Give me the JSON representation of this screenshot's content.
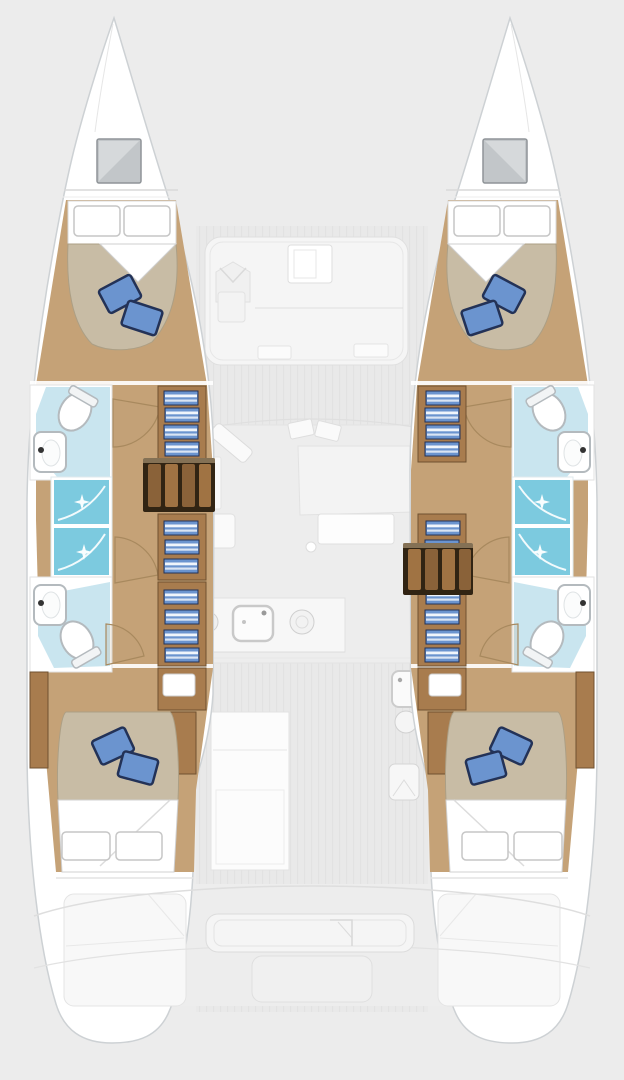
{
  "diagram": {
    "type": "yacht-floor-plan",
    "vessel": "catamaran",
    "view": "top-down interior layout, bows at top",
    "hull_count": 2,
    "counts": {
      "cabins": 4,
      "double_berths": 4,
      "bathrooms": 4,
      "shower_cubicles": 4,
      "bow_hatches": 2,
      "companionway_steps": 2
    },
    "port_hull_features": [
      "bow hatch",
      "forward double cabin with two blue throw pillows",
      "forward bathroom with toilet and washbasin",
      "two shower cubicles",
      "aft bathroom with washbasin and toilet",
      "inboard wardrobe shelving with folded blue linens",
      "companionway steps",
      "aft double cabin with two blue throw pillows",
      "stern platform"
    ],
    "starboard_hull_features": [
      "mirror image of port hull",
      "companionway steps positioned further aft"
    ],
    "center_features": [
      "forward cockpit lounge with table and V-backrest seat",
      "salon sofa",
      "salon table",
      "chaise seat",
      "galley counter with sink and burner",
      "galley island",
      "inboard service units with basin",
      "aft cockpit bench",
      "swim platform"
    ]
  },
  "colors": {
    "bg": "#ececec",
    "deck": "#e9e9e9",
    "deck_stripe": "#e2e2e2",
    "hull_fill": "#ffffff",
    "hull_stroke": "#cdd1d4",
    "faint_line": "#dfdfdf",
    "faint_fill": "#f5f5f5",
    "wood_floor": "#c5a277",
    "cabinet": "#a87c4e",
    "cabinet_edge": "#6f5130",
    "step_dark": "#312413",
    "step_tread": "#8a6239",
    "step_tread_light": "#a07343",
    "duvet": "#c8bca5",
    "duvet_edge": "#ac9f85",
    "pillow_blue": "#6b94cf",
    "pillow_edge": "#233257",
    "linen": "#ffffff",
    "linen_edge": "#c6c6c6",
    "bath_floor": "#c9e5ef",
    "shower": "#7ccadf",
    "fixture": "#b4babe",
    "hatch": "#c2c6c9",
    "hatch_light": "#d6d9db",
    "hatch_edge": "#8f9498",
    "door": "#a8895e",
    "door_fill": "rgba(190,160,120,0.18)"
  }
}
